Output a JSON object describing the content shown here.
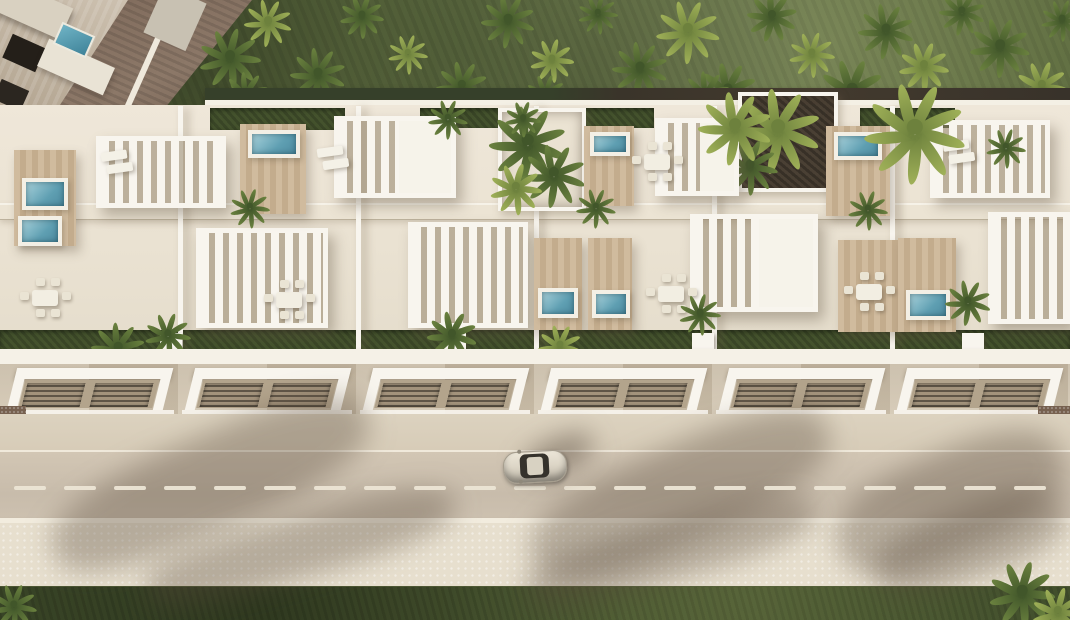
{
  "meta": {
    "alt": "Aerial 3D render of a modern white townhouse complex with rooftop terraces, pergolas, wooden decks with jacuzzis, palm garden behind, and a road with a silver car in front",
    "scene_type": "architectural aerial render, no text"
  },
  "palette": {
    "white": "#f8f5ee",
    "roof": "#eae2d2",
    "wood": "#d0bb9e",
    "woodDark": "#c3ac8d",
    "poolLight": "#a9d2db",
    "poolDeep": "#4d8ba0",
    "turf": "#44522d",
    "drive": "#7e695a",
    "pathDark": "#3f362c",
    "carBody": "#ddd6c7",
    "shadow": "rgba(86,71,55,0.34)"
  },
  "garden": {
    "palms": [
      [
        230,
        55,
        62,
        1
      ],
      [
        268,
        20,
        48,
        2
      ],
      [
        318,
        72,
        56,
        1
      ],
      [
        362,
        14,
        44,
        1
      ],
      [
        408,
        52,
        40,
        2
      ],
      [
        462,
        84,
        52,
        1
      ],
      [
        508,
        18,
        54,
        1
      ],
      [
        552,
        58,
        44,
        2
      ],
      [
        598,
        12,
        40,
        1
      ],
      [
        640,
        66,
        56,
        1
      ],
      [
        688,
        28,
        64,
        2
      ],
      [
        728,
        88,
        58,
        1
      ],
      [
        772,
        14,
        50,
        1
      ],
      [
        812,
        52,
        46,
        2
      ],
      [
        852,
        88,
        66,
        1
      ],
      [
        886,
        28,
        56,
        1
      ],
      [
        924,
        64,
        50,
        2
      ],
      [
        962,
        10,
        46,
        1
      ],
      [
        1000,
        44,
        60,
        1
      ],
      [
        1042,
        84,
        52,
        2
      ],
      [
        1062,
        18,
        42,
        1
      ],
      [
        246,
        92,
        46,
        1
      ],
      [
        546,
        92,
        40,
        1
      ],
      [
        706,
        92,
        48,
        1
      ]
    ],
    "drive_polygon": "polygon(125px 0px, 252px 0px, 165px 108px, 55px 108px)",
    "villa_polygon": "polygon(0px 0px, 128px 0px, 58px 108px, 0px 108px)",
    "pool": [
      56,
      28,
      32,
      20
    ],
    "dark_path": [
      640,
      88,
      430,
      17
    ]
  },
  "building": {
    "dividers": [
      178,
      356,
      534,
      712,
      890
    ],
    "turf_back": [
      [
        210,
        108,
        135,
        22
      ],
      [
        420,
        108,
        85,
        20
      ],
      [
        578,
        108,
        76,
        20
      ],
      [
        860,
        108,
        95,
        20
      ]
    ],
    "turf_front": [
      0,
      330,
      1070,
      24
    ],
    "pergolas": [
      [
        96,
        136,
        130,
        72,
        0
      ],
      [
        334,
        116,
        122,
        82,
        1
      ],
      [
        655,
        118,
        84,
        78,
        1
      ],
      [
        930,
        120,
        120,
        78,
        0
      ],
      [
        196,
        228,
        132,
        100,
        0
      ],
      [
        408,
        222,
        120,
        106,
        0
      ],
      [
        690,
        214,
        128,
        98,
        1
      ],
      [
        988,
        212,
        82,
        112,
        0
      ]
    ],
    "decks": [
      [
        14,
        150,
        62,
        96
      ],
      [
        240,
        124,
        66,
        90
      ],
      [
        584,
        126,
        50,
        80
      ],
      [
        826,
        126,
        64,
        90
      ],
      [
        534,
        238,
        48,
        92
      ],
      [
        588,
        238,
        44,
        92
      ],
      [
        838,
        240,
        60,
        92
      ],
      [
        898,
        238,
        58,
        94
      ]
    ],
    "jacuzzis": [
      [
        22,
        178,
        46,
        32
      ],
      [
        18,
        216,
        44,
        30
      ],
      [
        248,
        130,
        52,
        28
      ],
      [
        590,
        132,
        40,
        24
      ],
      [
        834,
        132,
        48,
        28
      ],
      [
        538,
        288,
        40,
        30
      ],
      [
        592,
        290,
        38,
        28
      ],
      [
        906,
        290,
        44,
        30
      ]
    ],
    "dining": [
      [
        18,
        276
      ],
      [
        262,
        278
      ],
      [
        630,
        140
      ],
      [
        644,
        272
      ],
      [
        842,
        270
      ]
    ],
    "loungers": [
      [
        102,
        150
      ],
      [
        318,
        146
      ],
      [
        944,
        140
      ]
    ],
    "planters": [
      [
        160,
        333
      ],
      [
        444,
        333
      ],
      [
        692,
        333
      ],
      [
        962,
        333
      ]
    ],
    "palms": [
      [
        168,
        333,
        46,
        1
      ],
      [
        118,
        346,
        54,
        1
      ],
      [
        250,
        206,
        40,
        1
      ],
      [
        448,
        117,
        40,
        1
      ],
      [
        523,
        117,
        36,
        1
      ],
      [
        452,
        333,
        50,
        1
      ],
      [
        560,
        344,
        44,
        2
      ],
      [
        596,
        206,
        40,
        1
      ],
      [
        700,
        312,
        42,
        1
      ],
      [
        735,
        124,
        74,
        2
      ],
      [
        915,
        127,
        102,
        2
      ],
      [
        968,
        300,
        46,
        1
      ],
      [
        1006,
        146,
        40,
        1
      ],
      [
        868,
        208,
        40,
        1
      ]
    ],
    "courtyards": [
      {
        "rect": [
          498,
          108,
          80,
          95
        ],
        "floor": "light",
        "palms": [
          [
            528,
            140,
            78,
            1
          ],
          [
            554,
            172,
            64,
            1
          ],
          [
            516,
            186,
            52,
            2
          ]
        ]
      },
      {
        "rect": [
          738,
          92,
          92,
          92
        ],
        "floor": "dark",
        "palms": [
          [
            778,
            126,
            86,
            2
          ],
          [
            750,
            164,
            56,
            1
          ]
        ]
      }
    ]
  },
  "facade": {
    "modules": [
      0,
      178,
      356,
      534,
      712,
      890
    ],
    "hedges": [
      [
        205,
        424,
        70,
        9
      ],
      [
        636,
        420,
        62,
        8
      ],
      [
        888,
        414,
        84,
        9
      ]
    ],
    "gravel": [
      [
        1038,
        406,
        32,
        42
      ],
      [
        0,
        406,
        26,
        42
      ]
    ]
  },
  "road": {
    "dash": {
      "y": 486,
      "len": 32,
      "gap": 18,
      "h": 4
    },
    "car": {
      "x": 503,
      "y": 451,
      "w": 62,
      "h": 30,
      "angle": -3
    },
    "shadows": [
      [
        40,
        436,
        340,
        95,
        -24
      ],
      [
        520,
        446,
        320,
        95,
        -24
      ],
      [
        830,
        452,
        240,
        100,
        -24
      ],
      [
        140,
        516,
        320,
        62,
        -16
      ],
      [
        520,
        522,
        300,
        58,
        -16
      ],
      [
        870,
        508,
        200,
        70,
        -20
      ]
    ]
  },
  "bottom": {
    "palms": [
      [
        1022,
        590,
        66,
        1
      ],
      [
        1058,
        610,
        52,
        2
      ],
      [
        14,
        604,
        46,
        1
      ]
    ]
  }
}
